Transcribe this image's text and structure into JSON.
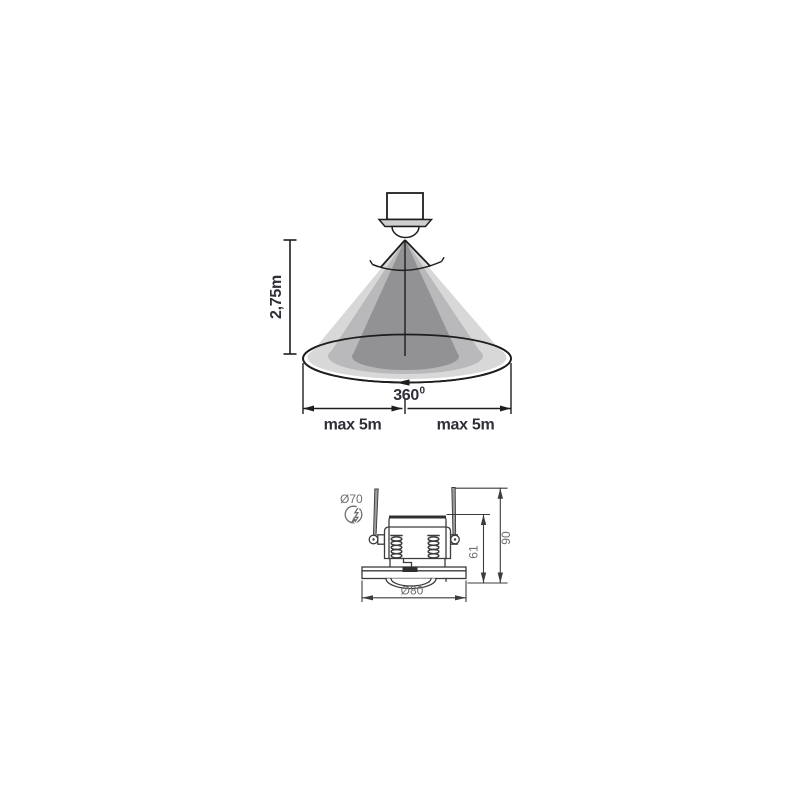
{
  "top_diagram": {
    "mounting_height_label": "2,75m",
    "rotation_value": "360",
    "rotation_superscript": "0",
    "range_left_label": "max 5m",
    "range_right_label": "max 5m",
    "colors": {
      "cone_light": "#d8d8d9",
      "cone_mid": "#b9b9bb",
      "cone_dark": "#929294",
      "outline": "#1e1e1e",
      "label_text": "#2f2f38"
    }
  },
  "bottom_diagram": {
    "cutout_diameter_label": "Ø70",
    "outer_diameter_label": "Ø80",
    "recess_depth_label": "61",
    "overall_height_label": "90",
    "colors": {
      "stroke": "#3c3c3c",
      "label_text": "#6f6f6f",
      "clip_fill": "#9c9c9c"
    }
  }
}
